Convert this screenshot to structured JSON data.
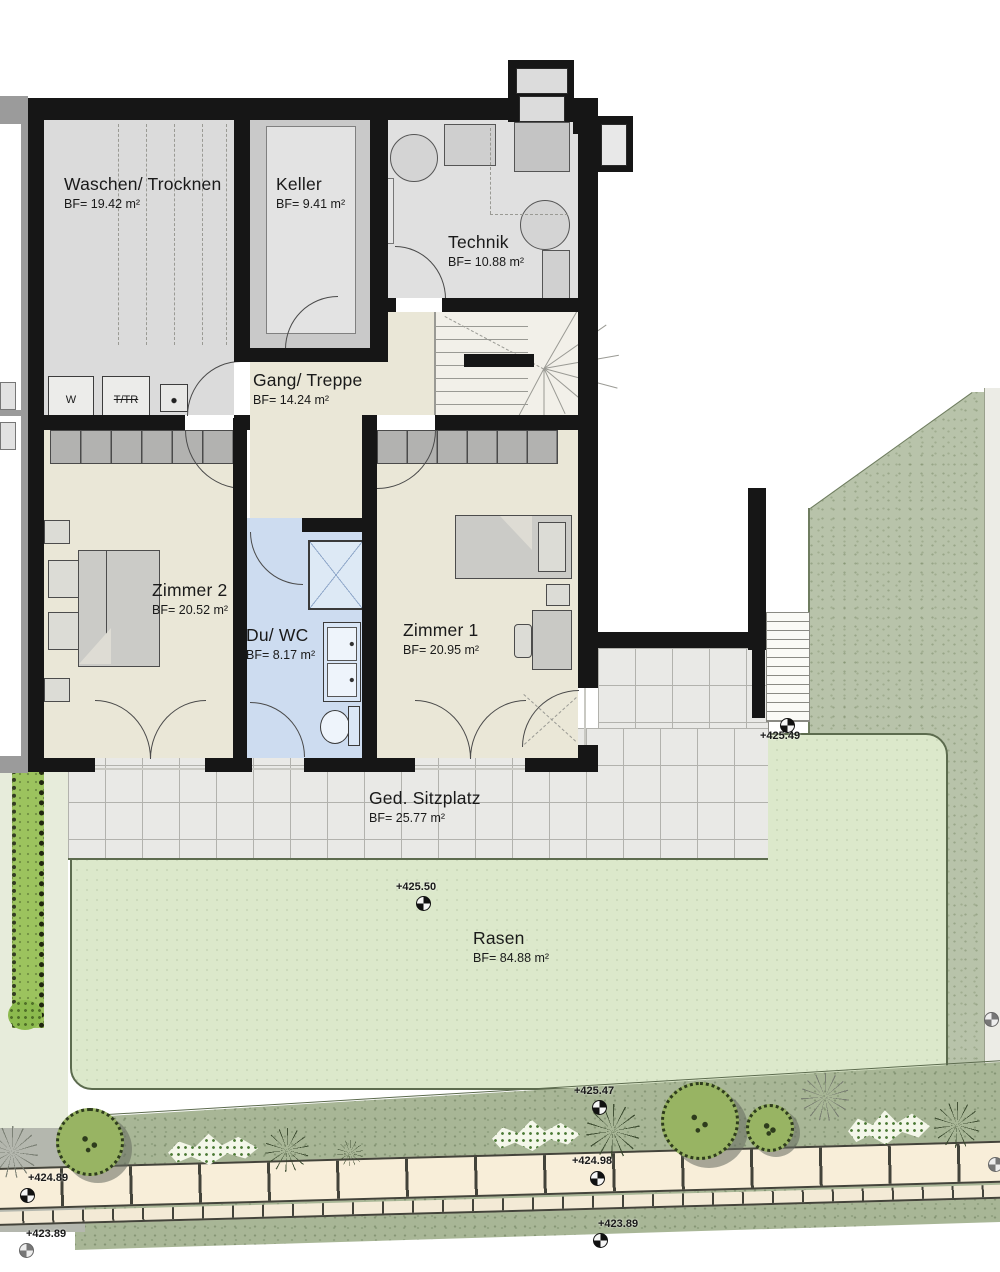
{
  "plan": {
    "title": "Untergeschoss Grundriss",
    "rooms": [
      {
        "id": "waschen",
        "name": "Waschen/ Trocknen",
        "area": "BF= 19.42 m²"
      },
      {
        "id": "keller",
        "name": "Keller",
        "area": "BF= 9.41 m²"
      },
      {
        "id": "technik",
        "name": "Technik",
        "area": "BF= 10.88 m²"
      },
      {
        "id": "gang",
        "name": "Gang/ Treppe",
        "area": "BF= 14.24 m²"
      },
      {
        "id": "zimmer2",
        "name": "Zimmer 2",
        "area": "BF= 20.52 m²"
      },
      {
        "id": "duwc",
        "name": "Du/ WC",
        "area": "BF= 8.17 m²"
      },
      {
        "id": "zimmer1",
        "name": "Zimmer 1",
        "area": "BF= 20.95 m²"
      },
      {
        "id": "sitzplatz",
        "name": "Ged. Sitzplatz",
        "area": "BF= 25.77 m²"
      },
      {
        "id": "rasen",
        "name": "Rasen",
        "area": "BF= 84.88 m²"
      }
    ],
    "appliances": {
      "washer": "W",
      "dryer": "T/TR"
    },
    "elevation_markers": [
      {
        "id": "m-ext-stair",
        "value": "+425.49"
      },
      {
        "id": "m-lawn",
        "value": "+425.50"
      },
      {
        "id": "m-bed-top",
        "value": "+425.47"
      },
      {
        "id": "m-bed-mid",
        "value": "+424.98"
      },
      {
        "id": "m-bed-bottom",
        "value": "+423.89"
      },
      {
        "id": "m-left-top",
        "value": "+424.89"
      },
      {
        "id": "m-left-bottom",
        "value": "+423.89"
      }
    ],
    "colors": {
      "wall": "#161616",
      "floor_cream": "#eae7d7",
      "floor_gray": "#dbdbdb",
      "bath_blue": "#cddcf0",
      "tiles": "#e9e9e6",
      "lawn": "#dce8cb",
      "slope_green": "#b8c3aa",
      "planting_band": "#a8b696",
      "stone_path": "#f8eed9",
      "hedge": "#9cc35e",
      "tree": "#98b463"
    }
  }
}
